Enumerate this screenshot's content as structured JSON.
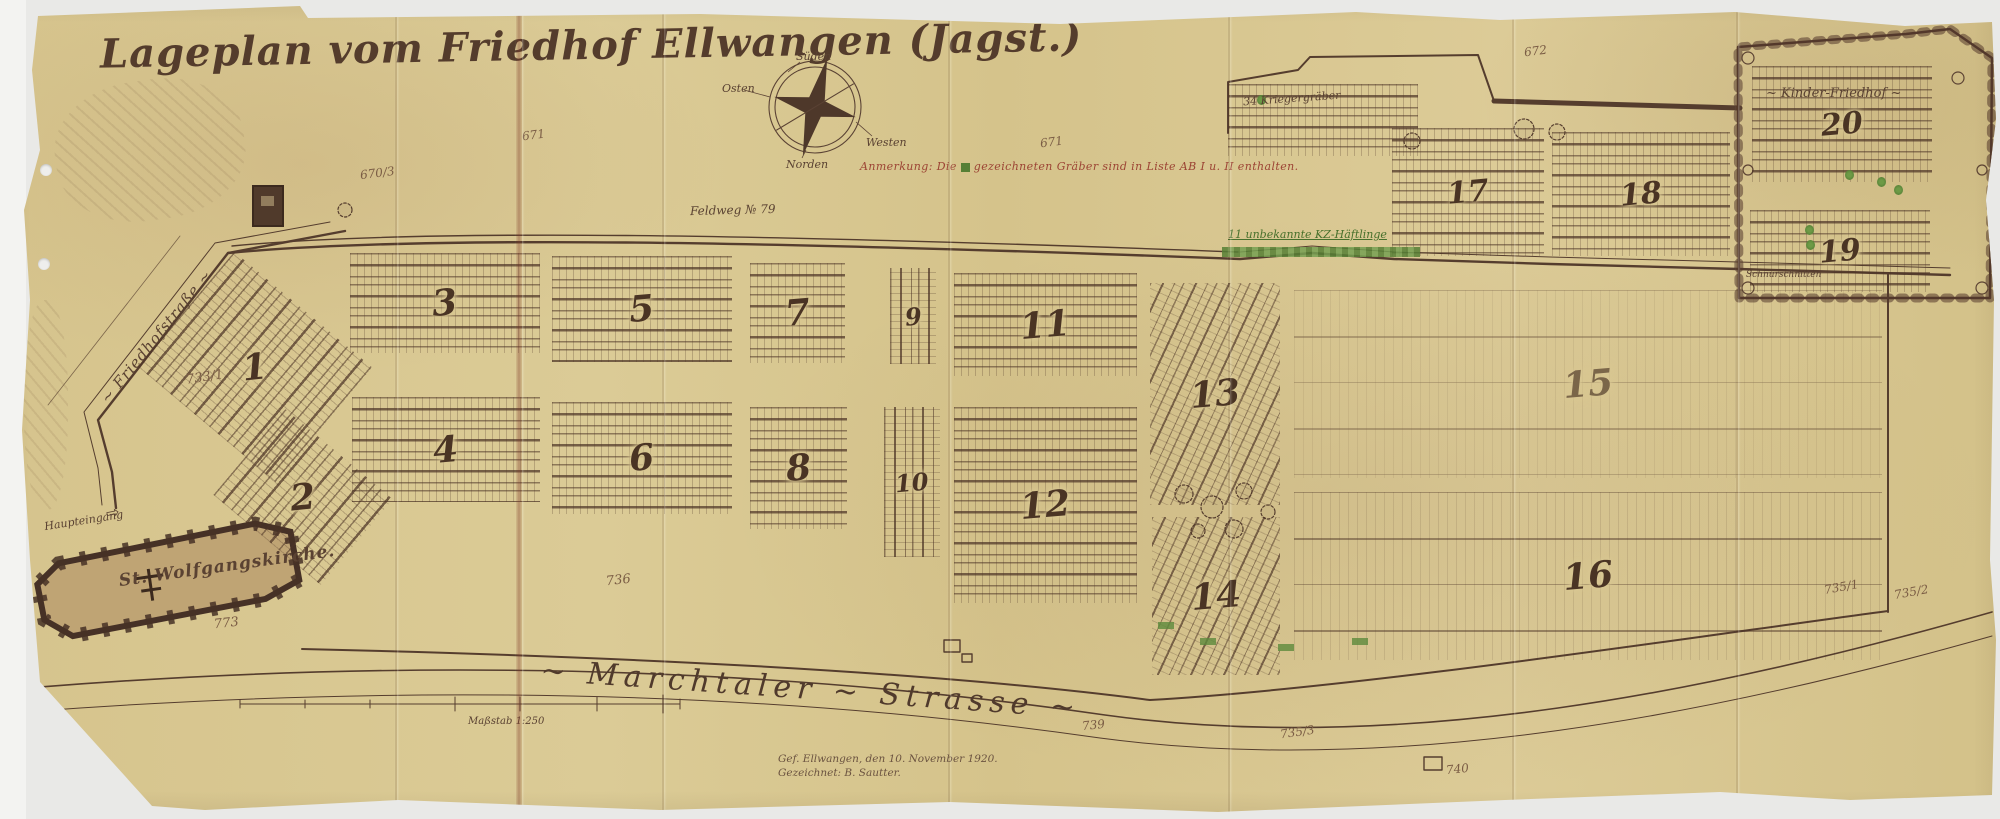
{
  "title": "Lageplan vom Friedhof Ellwangen (Jagst.)",
  "compass": {
    "north": "Norden",
    "south": "Süden",
    "east": "Osten",
    "west": "Westen"
  },
  "annotations": {
    "note_prefix": "Anmerkung: Die",
    "note_suffix": "gezeichneten Gräber sind in Liste AB I u. II enthalten.",
    "kriegergraeber": "34 Kriegergräber",
    "kz": "11 unbekannte KZ-Häftlinge",
    "massstab": "Maßstab 1:250"
  },
  "roads": {
    "friedhofstrasse": "~ Friedhofstraße ~",
    "marchtaler": "~ Marchtaler ~ Strasse ~",
    "feldweg": "Feldweg № 79"
  },
  "church": {
    "name": "St. Wolfgangskirche.",
    "entrance": "Haupteingang",
    "arrow": "⇨"
  },
  "kinder": {
    "label": "~ Kinder-Friedhof ~",
    "bottom_label": "Schnurschnitten"
  },
  "signature": {
    "line1": "Gef. Ellwangen, den 10. November 1920.",
    "line2": "Gezeichnet: B. Sautter."
  },
  "sections": [
    {
      "label": "1"
    },
    {
      "label": "2"
    },
    {
      "label": "3"
    },
    {
      "label": "4"
    },
    {
      "label": "5"
    },
    {
      "label": "6"
    },
    {
      "label": "7"
    },
    {
      "label": "8"
    },
    {
      "label": "9"
    },
    {
      "label": "10"
    },
    {
      "label": "11"
    },
    {
      "label": "12"
    },
    {
      "label": "13"
    },
    {
      "label": "14"
    },
    {
      "label": "15"
    },
    {
      "label": "16"
    },
    {
      "label": "17"
    },
    {
      "label": "18"
    },
    {
      "label": "19"
    },
    {
      "label": "20"
    }
  ],
  "elevations": [
    {
      "text": "670/3"
    },
    {
      "text": "671"
    },
    {
      "text": "671"
    },
    {
      "text": "672"
    },
    {
      "text": "733/1"
    },
    {
      "text": "736"
    },
    {
      "text": "773"
    },
    {
      "text": "739"
    },
    {
      "text": "735/3"
    },
    {
      "text": "740"
    },
    {
      "text": "735/1"
    },
    {
      "text": "735/2"
    }
  ],
  "palette": {
    "paper": "#d9c893",
    "ink": "#4f382c",
    "red_note": "#9c4434",
    "grave_green": "#567f35",
    "scan_bg": "#e9e9e7"
  }
}
